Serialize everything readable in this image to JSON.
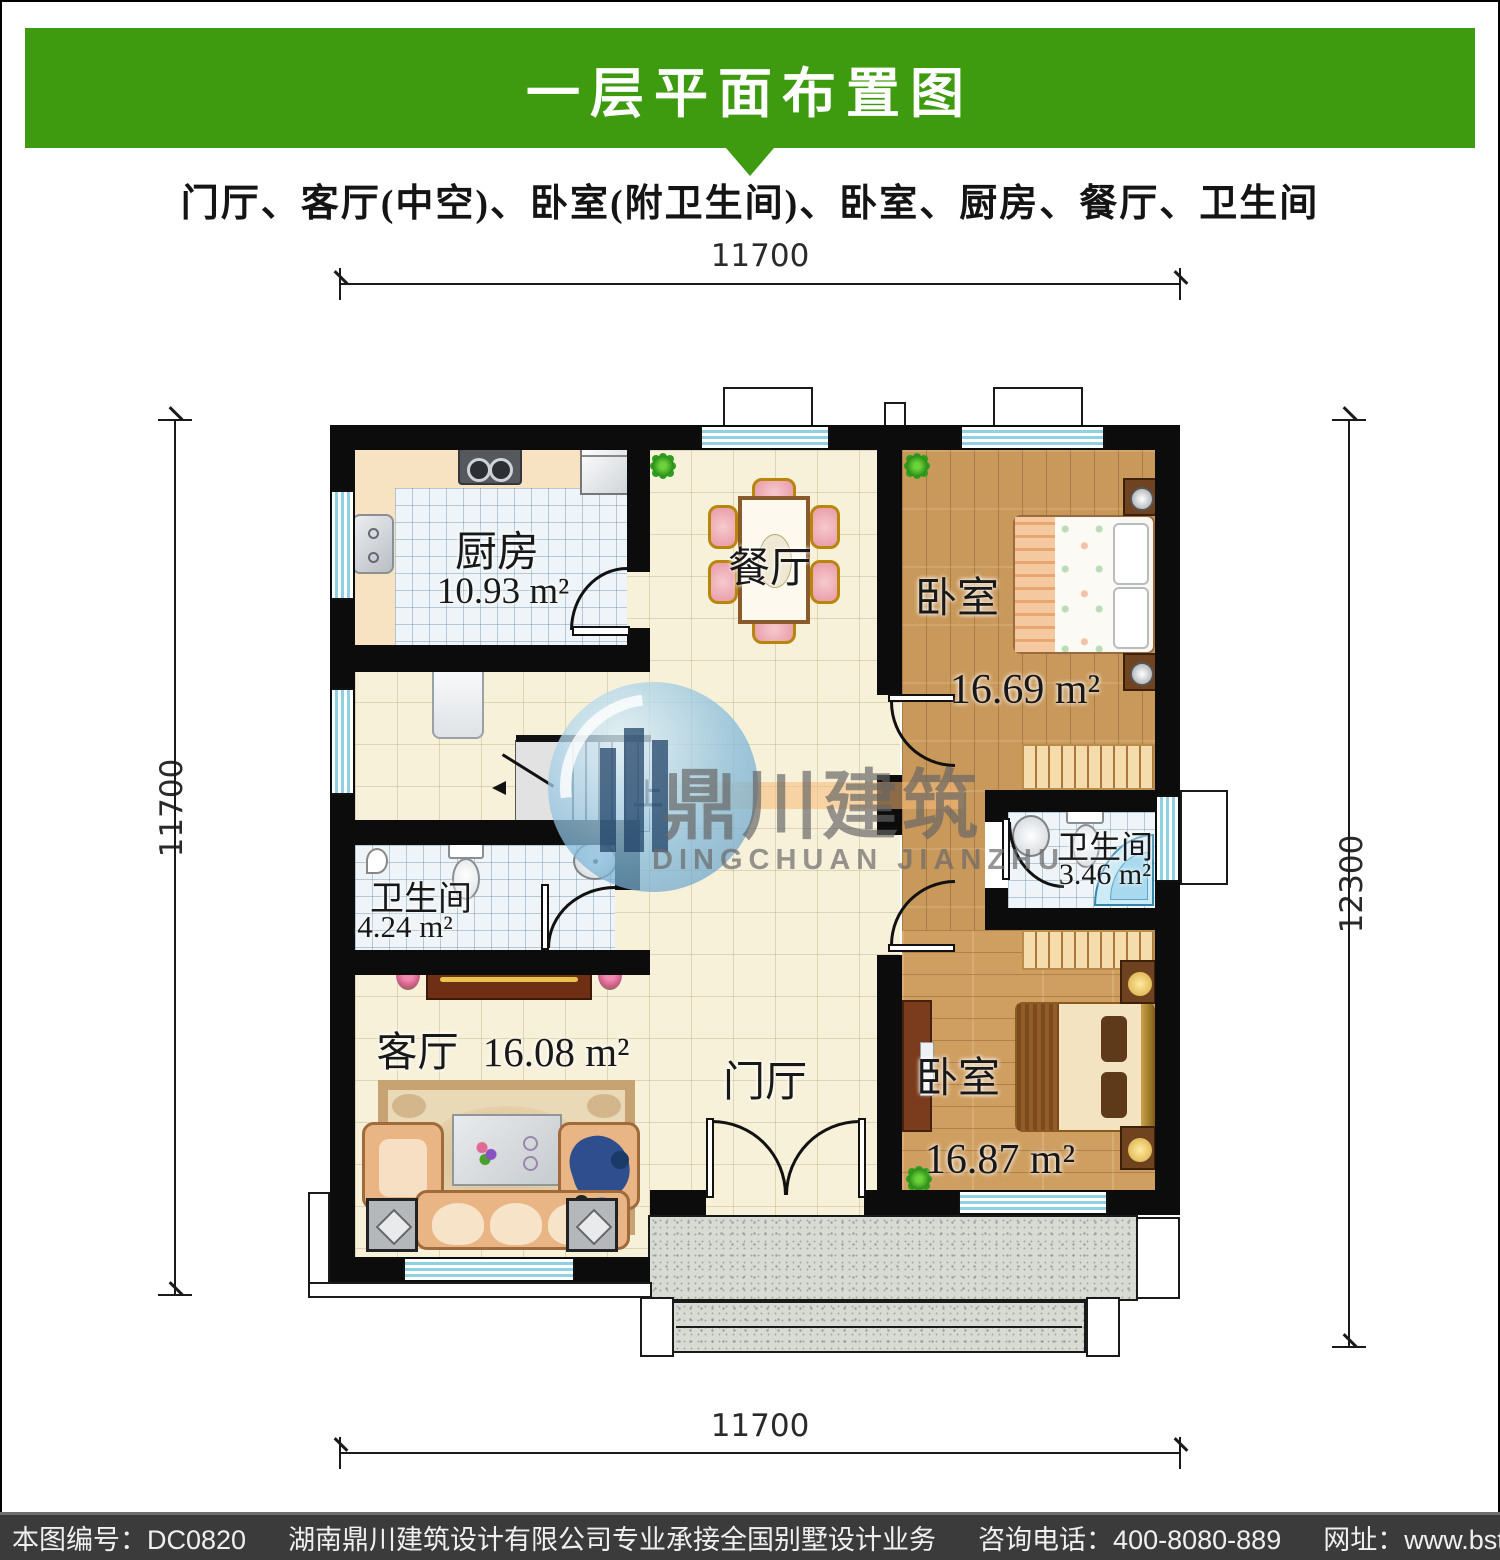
{
  "header": {
    "title": "一层平面布置图",
    "subtitle": "门厅、客厅(中空)、卧室(附卫生间)、卧室、厨房、餐厅、卫生间"
  },
  "dimensions": {
    "top": "11700",
    "bottom": "11700",
    "left": "11700",
    "right": "12300"
  },
  "rooms": {
    "kitchen": {
      "name": "厨房",
      "area": "10.93 m²"
    },
    "dining": {
      "name": "餐厅"
    },
    "bedroom_top": {
      "name": "卧室",
      "area": "16.69 m²"
    },
    "bathroom_ensuite": {
      "name": "卫生间",
      "area": "3.46 m²"
    },
    "bathroom_main": {
      "name": "卫生间",
      "area": "4.24 m²"
    },
    "living": {
      "name": "客厅",
      "area": "16.08 m²"
    },
    "foyer": {
      "name": "门厅"
    },
    "bedroom_bottom": {
      "name": "卧室",
      "area": "16.87 m²"
    }
  },
  "stairs": {
    "up": "上"
  },
  "watermark": {
    "cn": "鼎川建筑",
    "en": "DINGCHUAN JIANZHU"
  },
  "footer": {
    "plan_no": "本图编号：DC0820",
    "company": "湖南鼎川建筑设计有限公司专业承接全国别墅设计业务",
    "phone": "咨询电话：400-8080-889",
    "website": "网址：www.bstzcs.com"
  },
  "colors": {
    "banner_green": "#3e9b10",
    "footer_bg": "#3b3b3b",
    "wall_black": "#0c0c0c",
    "wood": "#c9995c",
    "tile_cream": "#f7f1da",
    "tile_blue": "#eef4f7",
    "window_blue": "#8fd0e2",
    "granite": "#d7dbd3",
    "watermark_blue": "#7fb6d9"
  }
}
